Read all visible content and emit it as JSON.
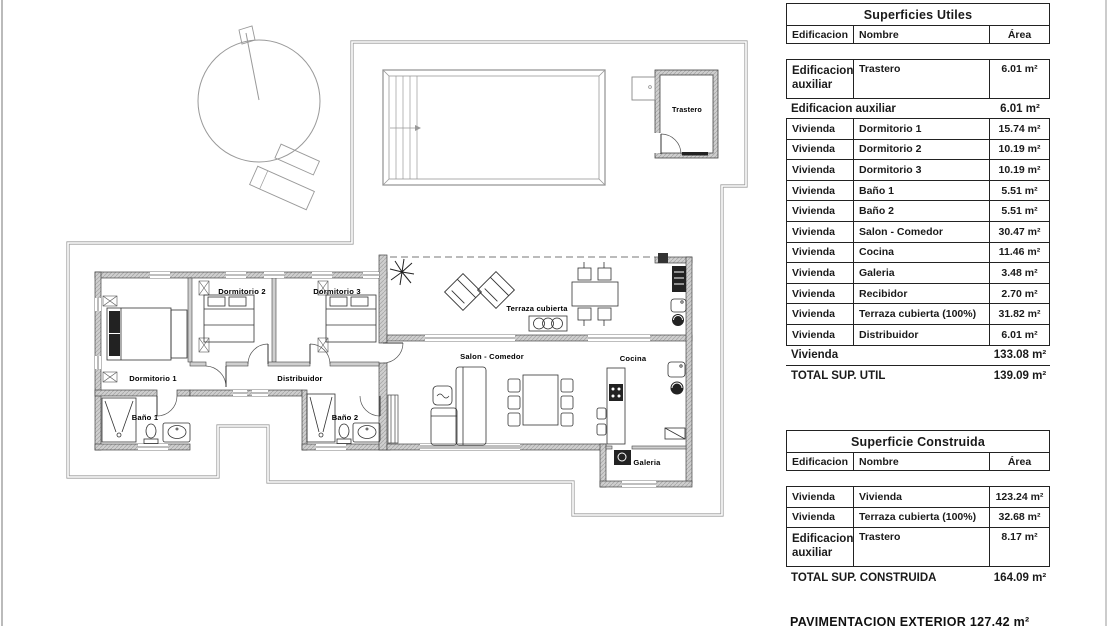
{
  "plan": {
    "labels": {
      "trastero": "Trastero",
      "dormitorio1": "Dormitorio 1",
      "dormitorio2": "Dormitorio 2",
      "dormitorio3": "Dormitorio 3",
      "distribuidor": "Distribuidor",
      "bano1": "Baño 1",
      "bano2": "Baño 2",
      "terraza": "Terraza cubierta",
      "salon": "Salon - Comedor",
      "cocina": "Cocina",
      "galeria": "Galeria"
    },
    "colors": {
      "wall_fill": "#cfcfcf",
      "line": "#444444",
      "boundary": "#9b9b9b"
    }
  },
  "tables": {
    "utiles": {
      "title": "Superficies Utiles",
      "headers": {
        "edificacion": "Edificacion",
        "nombre": "Nombre",
        "area": "Área"
      },
      "aux_row": {
        "edificacion": "Edificacion auxiliar",
        "nombre": "Trastero",
        "area": "6.01 m²"
      },
      "aux_subtotal": {
        "label": "Edificacion auxiliar",
        "area": "6.01 m²"
      },
      "rows": [
        {
          "edificacion": "Vivienda",
          "nombre": "Dormitorio 1",
          "area": "15.74 m²"
        },
        {
          "edificacion": "Vivienda",
          "nombre": "Dormitorio 2",
          "area": "10.19 m²"
        },
        {
          "edificacion": "Vivienda",
          "nombre": "Dormitorio 3",
          "area": "10.19 m²"
        },
        {
          "edificacion": "Vivienda",
          "nombre": "Baño 1",
          "area": "5.51 m²"
        },
        {
          "edificacion": "Vivienda",
          "nombre": "Baño 2",
          "area": "5.51 m²"
        },
        {
          "edificacion": "Vivienda",
          "nombre": "Salon - Comedor",
          "area": "30.47 m²"
        },
        {
          "edificacion": "Vivienda",
          "nombre": "Cocina",
          "area": "11.46 m²"
        },
        {
          "edificacion": "Vivienda",
          "nombre": "Galeria",
          "area": "3.48 m²"
        },
        {
          "edificacion": "Vivienda",
          "nombre": "Recibidor",
          "area": "2.70 m²"
        },
        {
          "edificacion": "Vivienda",
          "nombre": "Terraza cubierta (100%)",
          "area": "31.82 m²"
        },
        {
          "edificacion": "Vivienda",
          "nombre": "Distribuidor",
          "area": "6.01 m²"
        }
      ],
      "viv_subtotal": {
        "label": "Vivienda",
        "area": "133.08 m²"
      },
      "total": {
        "label": "TOTAL SUP. UTIL",
        "area": "139.09 m²"
      }
    },
    "construida": {
      "title": "Superficie Construida",
      "headers": {
        "edificacion": "Edificacion",
        "nombre": "Nombre",
        "area": "Área"
      },
      "rows": [
        {
          "edificacion": "Vivienda",
          "nombre": "Vivienda",
          "area": "123.24 m²"
        },
        {
          "edificacion": "Vivienda",
          "nombre": "Terraza cubierta (100%)",
          "area": "32.68 m²"
        },
        {
          "edificacion": "Edificacion auxiliar",
          "nombre": "Trastero",
          "area": "8.17 m²"
        }
      ],
      "total": {
        "label": "TOTAL SUP. CONSTRUIDA",
        "area": "164.09 m²"
      }
    },
    "footer": "PAVIMENTACION EXTERIOR 127.42 m²"
  }
}
